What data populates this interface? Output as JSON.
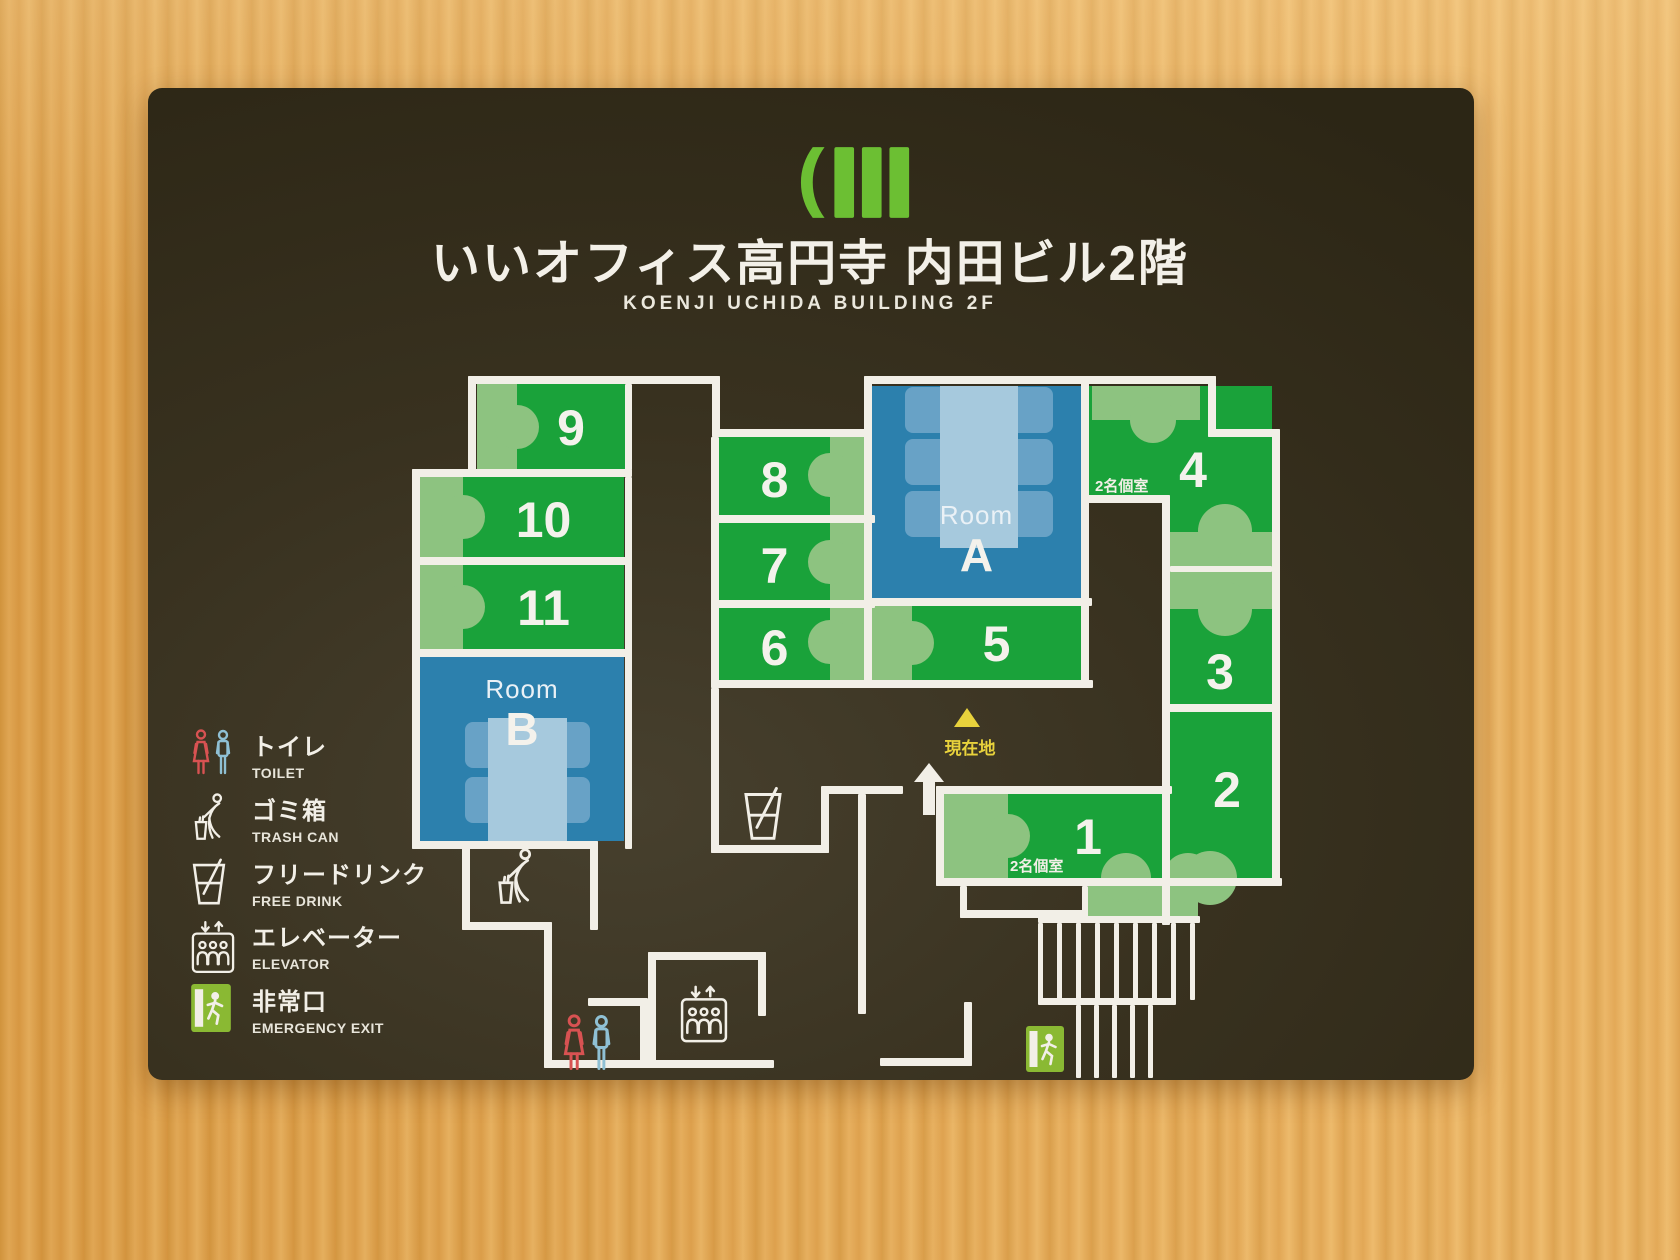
{
  "header": {
    "title": "いいオフィス高円寺 内田ビル2階",
    "subtitle": "KOENJI UCHIDA BUILDING 2F",
    "logo": "ii-office-logo"
  },
  "legend": {
    "items": [
      {
        "id": "toilet",
        "jp": "トイレ",
        "en": "TOILET",
        "icon": "toilet-icon"
      },
      {
        "id": "trash",
        "jp": "ゴミ箱",
        "en": "TRASH CAN",
        "icon": "trash-can-icon"
      },
      {
        "id": "drink",
        "jp": "フリードリンク",
        "en": "FREE DRINK",
        "icon": "free-drink-icon"
      },
      {
        "id": "elevator",
        "jp": "エレベーター",
        "en": "ELEVATOR",
        "icon": "elevator-icon"
      },
      {
        "id": "exit",
        "jp": "非常口",
        "en": "EMERGENCY EXIT",
        "icon": "emergency-exit-icon"
      }
    ]
  },
  "floorplan": {
    "booths": [
      {
        "number": "1"
      },
      {
        "number": "2"
      },
      {
        "number": "3"
      },
      {
        "number": "4"
      },
      {
        "number": "5"
      },
      {
        "number": "6"
      },
      {
        "number": "7"
      },
      {
        "number": "8"
      },
      {
        "number": "9"
      },
      {
        "number": "10"
      },
      {
        "number": "11"
      }
    ],
    "rooms": {
      "a": {
        "word": "Room",
        "letter": "A"
      },
      "b": {
        "word": "Room",
        "letter": "B"
      }
    },
    "private_label_booth4": "2名個室",
    "private_label_booth1": "2名個室",
    "current_location": "現在地"
  },
  "colors": {
    "board": "#38311f",
    "wood": "#e2a44f",
    "booth_green": "#1aa23a",
    "desk_green": "#8dc380",
    "room_blue": "#2c80ad",
    "table_blue": "#a6c9dd",
    "room_chair_blue": "#68a2c6",
    "logo_green": "#6cbf33",
    "wall_white": "#f2efe7",
    "highlight_yellow": "#e8d23c",
    "toilet_red": "#d85252",
    "toilet_blue": "#8fc0d4",
    "exit_green": "#8ab933"
  }
}
